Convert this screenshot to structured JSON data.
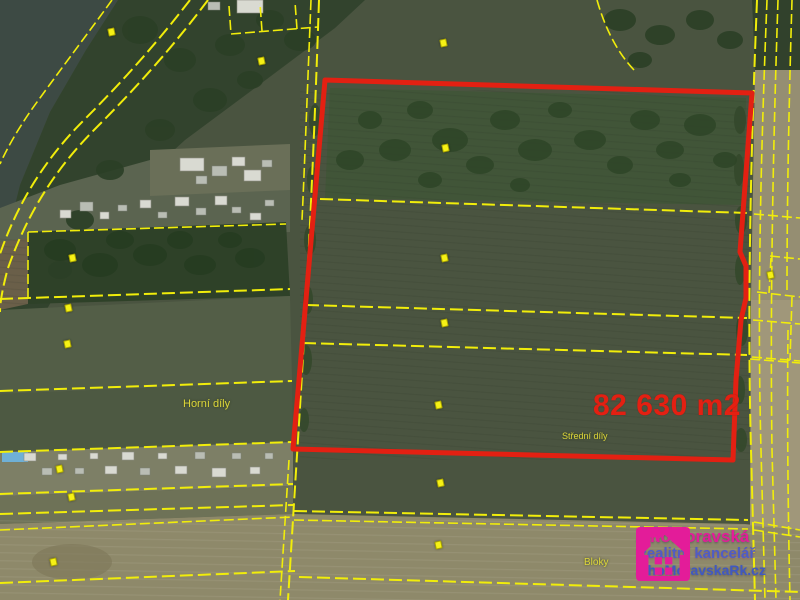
{
  "map": {
    "area_label": "82 630 m2",
    "labels": [
      {
        "text": "Horní díly"
      },
      {
        "text": "Střední díly"
      },
      {
        "text": "Bloky"
      }
    ],
    "markers": [
      [
        111,
        32
      ],
      [
        261,
        61
      ],
      [
        443,
        43
      ],
      [
        445,
        148
      ],
      [
        72,
        258
      ],
      [
        68,
        308
      ],
      [
        67,
        344
      ],
      [
        444,
        258
      ],
      [
        444,
        323
      ],
      [
        438,
        405
      ],
      [
        440,
        483
      ],
      [
        438,
        545
      ],
      [
        59,
        469
      ],
      [
        71,
        497
      ],
      [
        53,
        562
      ],
      [
        770,
        275
      ]
    ],
    "colors": {
      "selected_parcel_outline": "#e32012",
      "area_text": "#e32012",
      "cadastral_lines": "#f1ed0a",
      "place_label_text": "#ded73a"
    }
  },
  "watermark": {
    "brand": "JihoMoravská",
    "subtitle": "Realitní kancelář",
    "website": "JihoMoravskaRk.cz",
    "brand_color": "#e7189b",
    "subtitle_color": "#4d5bc9",
    "website_color": "#3d57c5"
  }
}
